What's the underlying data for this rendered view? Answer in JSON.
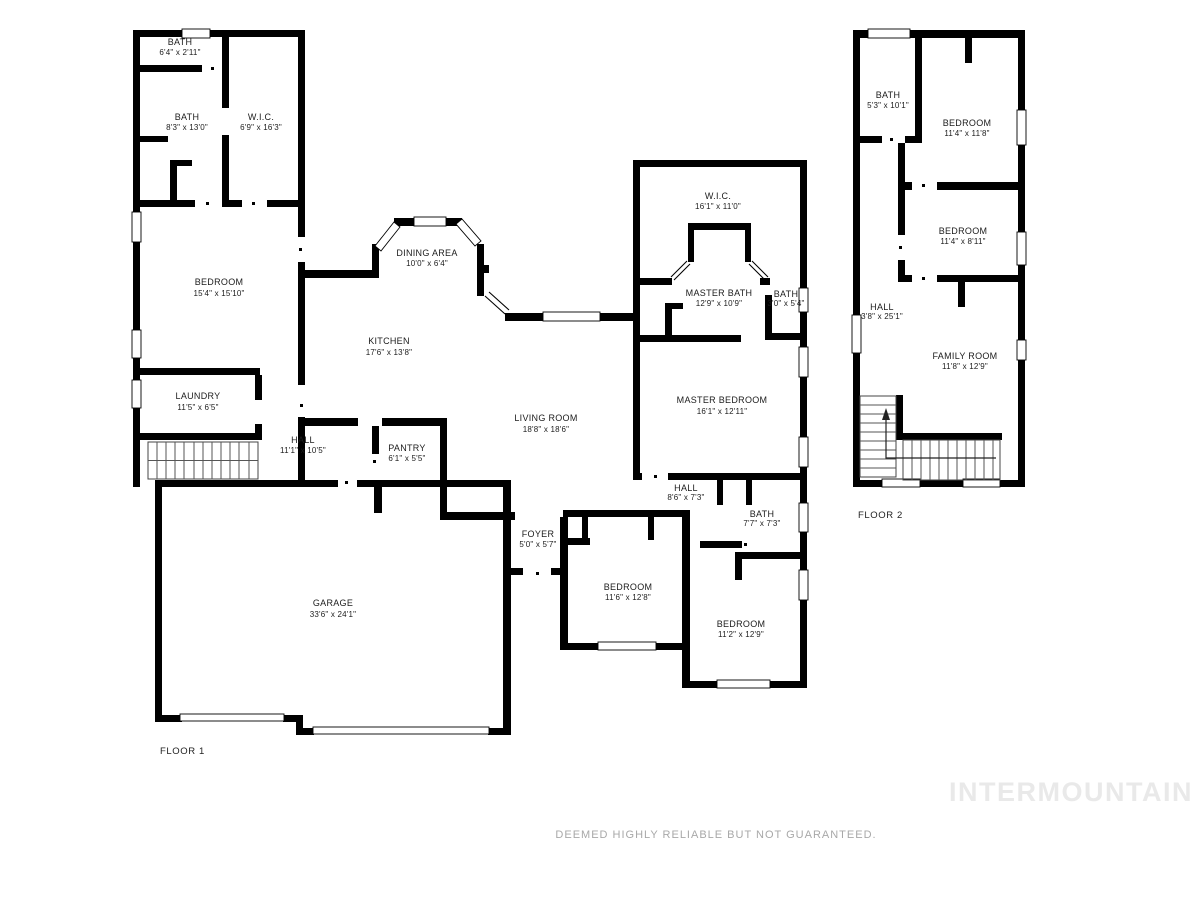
{
  "floors": [
    {
      "label": "FLOOR 1",
      "rooms": [
        {
          "name": "BATH",
          "dims": "6'4\" x 2'11\""
        },
        {
          "name": "BATH",
          "dims": "8'3\" x 13'0\""
        },
        {
          "name": "W.I.C.",
          "dims": "6'9\" x 16'3\""
        },
        {
          "name": "BEDROOM",
          "dims": "15'4\" x 15'10\""
        },
        {
          "name": "DINING AREA",
          "dims": "10'0\" x 6'4\""
        },
        {
          "name": "KITCHEN",
          "dims": "17'6\" x 13'8\""
        },
        {
          "name": "LAUNDRY",
          "dims": "11'5\" x 6'5\""
        },
        {
          "name": "HALL",
          "dims": "11'1\" x 10'5\""
        },
        {
          "name": "PANTRY",
          "dims": "6'1\" x 5'5\""
        },
        {
          "name": "LIVING ROOM",
          "dims": "18'8\" x 18'6\""
        },
        {
          "name": "W.I.C.",
          "dims": "16'1\" x 11'0\""
        },
        {
          "name": "MASTER BATH",
          "dims": "12'9\" x 10'9\""
        },
        {
          "name": "BATH",
          "dims": "3'0\" x 5'4\""
        },
        {
          "name": "MASTER BEDROOM",
          "dims": "16'1\" x 12'11\""
        },
        {
          "name": "HALL",
          "dims": "8'6\" x 7'3\""
        },
        {
          "name": "BATH",
          "dims": "7'7\" x 7'3\""
        },
        {
          "name": "FOYER",
          "dims": "5'0\" x 5'7\""
        },
        {
          "name": "BEDROOM",
          "dims": "11'6\" x 12'8\""
        },
        {
          "name": "BEDROOM",
          "dims": "11'2\" x 12'9\""
        },
        {
          "name": "GARAGE",
          "dims": "33'6\" x 24'1\""
        }
      ]
    },
    {
      "label": "FLOOR 2",
      "rooms": [
        {
          "name": "BATH",
          "dims": "5'3\" x 10'1\""
        },
        {
          "name": "BEDROOM",
          "dims": "11'4\" x 11'8\""
        },
        {
          "name": "BEDROOM",
          "dims": "11'4\" x 8'11\""
        },
        {
          "name": "HALL",
          "dims": "3'8\" x 25'1\""
        },
        {
          "name": "FAMILY ROOM",
          "dims": "11'8\" x 12'9\""
        }
      ]
    }
  ],
  "footer": {
    "disclaimer": "DEEMED HIGHLY RELIABLE BUT NOT GUARANTEED."
  },
  "watermark": "INTERMOUNTAIN",
  "colors": {
    "wall": "#000000",
    "text": "#1c1c1c",
    "disclaimer": "#a8a8a8",
    "watermark": "#e9e9e9",
    "background": "#ffffff"
  }
}
